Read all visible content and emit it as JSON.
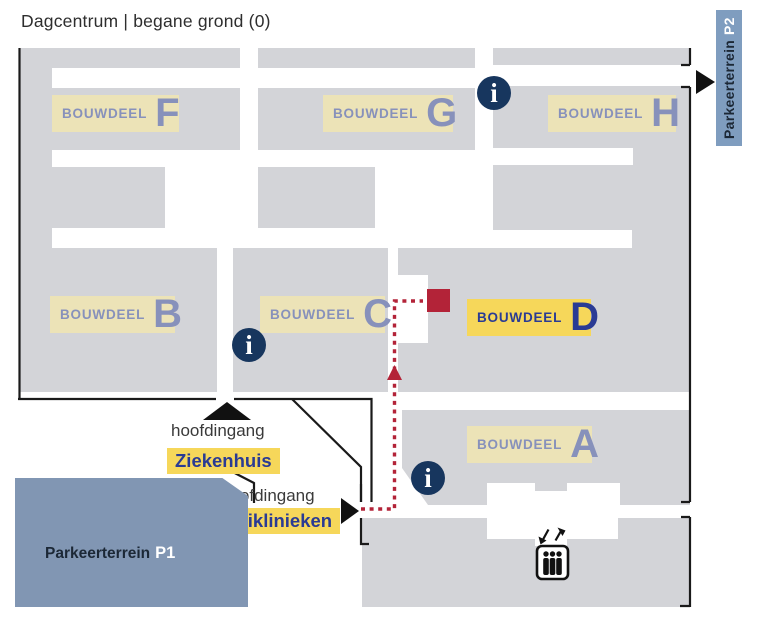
{
  "title": "Dagcentrum | begane grond (0)",
  "buildings": [
    {
      "word": "BOUWDEEL",
      "letter": "F"
    },
    {
      "word": "BOUWDEEL",
      "letter": "G"
    },
    {
      "word": "BOUWDEEL",
      "letter": "H"
    },
    {
      "word": "BOUWDEEL",
      "letter": "B"
    },
    {
      "word": "BOUWDEEL",
      "letter": "C"
    },
    {
      "word": "BOUWDEEL",
      "letter": "D"
    },
    {
      "word": "BOUWDEEL",
      "letter": "A"
    }
  ],
  "entrances": {
    "hospital": {
      "prefix": "hoofdingang",
      "name": "Ziekenhuis"
    },
    "clinics": {
      "prefix": "hoofdingang",
      "name": "Poliklinieken"
    }
  },
  "parking": {
    "p1": {
      "label": "Parkeerterrein",
      "code": "P1"
    },
    "p2": {
      "label": "Parkeerterrein",
      "code": "P2"
    }
  },
  "info_icon_glyph": "i",
  "colors": {
    "block_gray": "#d3d4d8",
    "label_cream": "#ece3b7",
    "label_blue": "#8791bb",
    "highlight_yellow": "#f6d75a",
    "highlight_blue": "#2a3b94",
    "route_red": "#b32338",
    "info_navy": "#17365e",
    "parking_p1": "#8196b3",
    "parking_p2": "#7f9dbf",
    "outline_black": "#1a1a1a"
  }
}
